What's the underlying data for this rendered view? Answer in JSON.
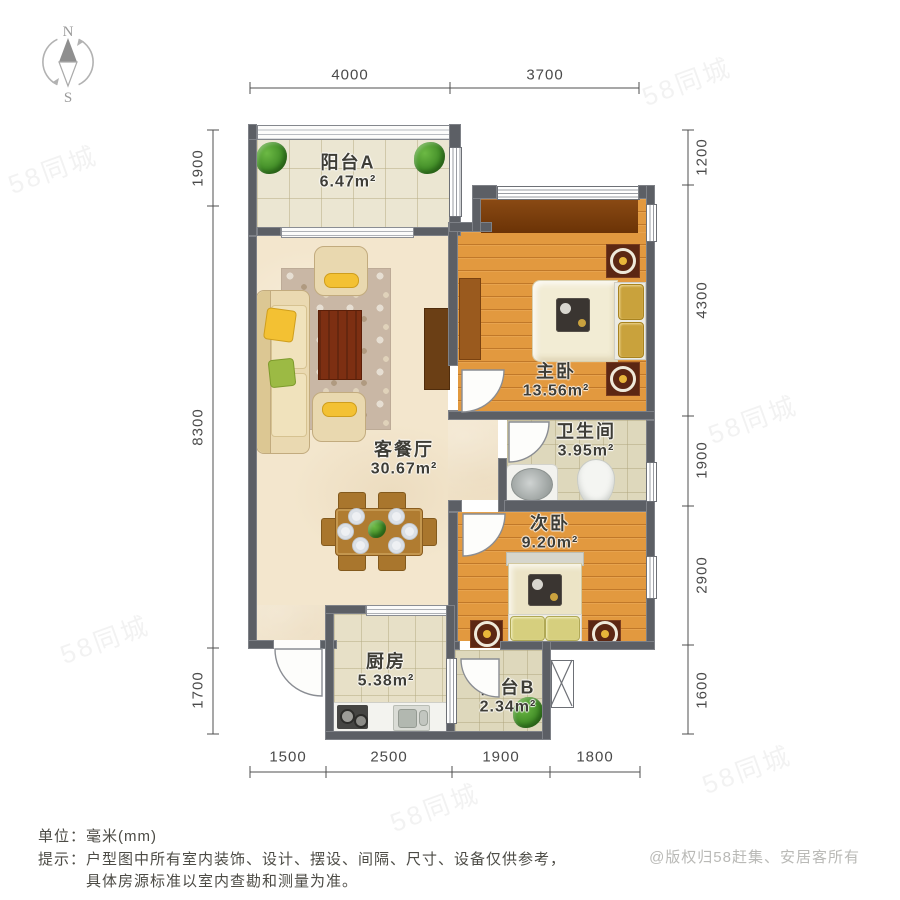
{
  "compass": {
    "north": "N",
    "south": "S"
  },
  "dims": {
    "top": [
      "4000",
      "3700"
    ],
    "bottom": [
      "1500",
      "2500",
      "1900",
      "1800"
    ],
    "left": [
      "1900",
      "8300",
      "1700"
    ],
    "right": [
      "1200",
      "4300",
      "1900",
      "2900",
      "1600"
    ]
  },
  "rooms": {
    "balcony_a": {
      "name": "阳台A",
      "area": "6.47m²"
    },
    "living": {
      "name": "客餐厅",
      "area": "30.67m²"
    },
    "master": {
      "name": "主卧",
      "area": "13.56m²"
    },
    "bath": {
      "name": "卫生间",
      "area": "3.95m²"
    },
    "second": {
      "name": "次卧",
      "area": "9.20m²"
    },
    "kitchen": {
      "name": "厨房",
      "area": "5.38m²"
    },
    "balcony_b": {
      "name": "阳台B",
      "area": "2.34m²"
    }
  },
  "footer": {
    "unit_label": "单位：",
    "unit_value": "毫米(mm)",
    "tip_label": "提示：",
    "tip_line1": "户型图中所有室内装饰、设计、摆设、间隔、尺寸、设备仅供参考，",
    "tip_line2": "具体房源标准以室内查勘和测量为准。",
    "copyright": "@版权归58赶集、安居客所有"
  },
  "watermark": "58同城",
  "colors": {
    "wall": "#5c5f65",
    "wood_floor": "#e2993f",
    "living_floor": "#f3e6cd",
    "wardrobe": "#7c3d0e",
    "accent_yellow": "#f3c133",
    "plant_green": "#3f8a26"
  }
}
